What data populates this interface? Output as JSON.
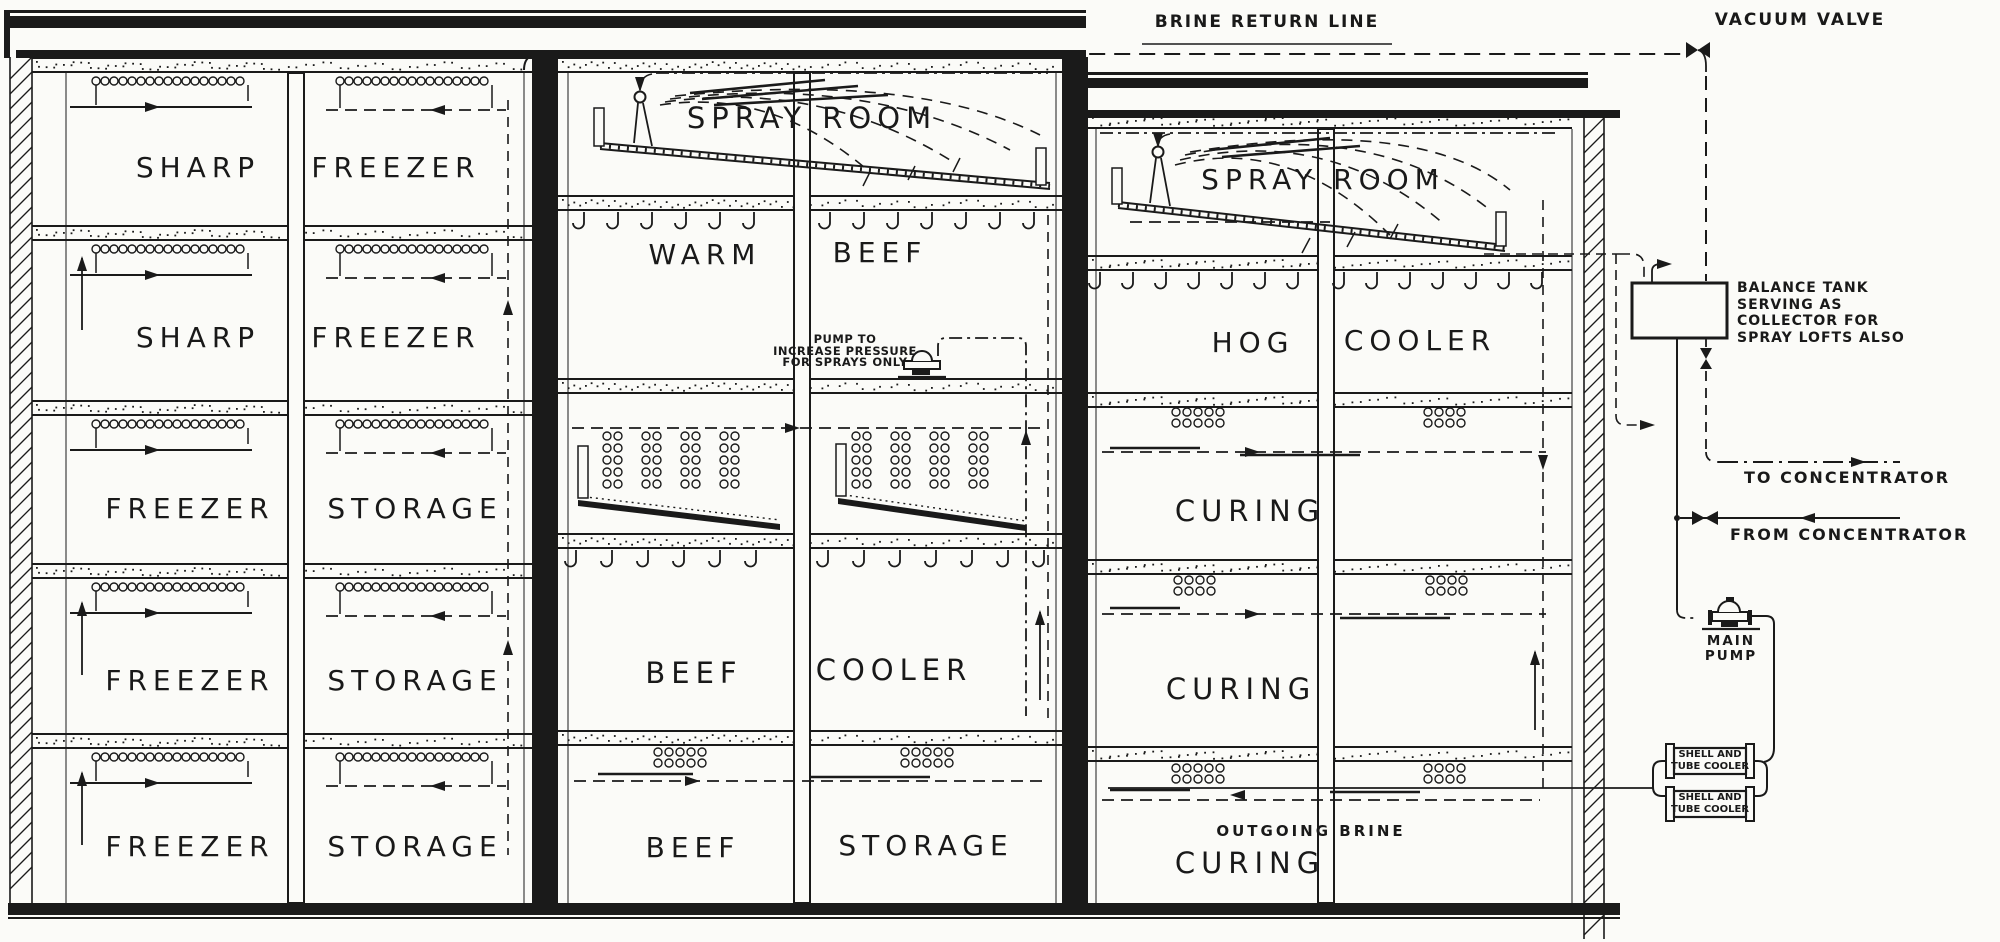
{
  "colors": {
    "ink": "#1a1a1a",
    "paper": "#fbfbf8"
  },
  "top_labels": {
    "brine_return_line": "BRINE RETURN LINE",
    "vacuum_valve": "VACUUM VALVE"
  },
  "left_building": {
    "floors": [
      {
        "rooms": [
          "SHARP",
          "FREEZER"
        ]
      },
      {
        "rooms": [
          "SHARP",
          "FREEZER"
        ]
      },
      {
        "rooms": [
          "FREEZER",
          "STORAGE"
        ]
      },
      {
        "rooms": [
          "FREEZER",
          "STORAGE"
        ]
      },
      {
        "rooms": [
          "FREEZER",
          "STORAGE"
        ]
      }
    ]
  },
  "middle_building": {
    "spray_room": "SPRAY ROOM",
    "floor2_rooms": [
      "WARM",
      "BEEF"
    ],
    "pump_note_lines": [
      "PUMP TO",
      "INCREASE PRESSURE",
      "FOR SPRAYS ONLY"
    ],
    "floor4_rooms": [
      "BEEF",
      "COOLER"
    ],
    "floor5_rooms": [
      "BEEF",
      "STORAGE"
    ]
  },
  "right_building": {
    "spray_room": "SPRAY ROOM",
    "floor2_rooms": [
      "HOG",
      "COOLER"
    ],
    "floor3_room": "CURING",
    "floor4_room": "CURING",
    "floor5_room": "CURING",
    "outgoing_brine_label": "OUTGOING BRINE"
  },
  "external": {
    "balance_tank_note_lines": [
      "BALANCE TANK",
      "SERVING AS",
      "COLLECTOR FOR",
      "SPRAY LOFTS ALSO"
    ],
    "to_concentrator": "TO CONCENTRATOR",
    "from_concentrator": "FROM CONCENTRATOR",
    "main_pump_lines": [
      "MAIN",
      "PUMP"
    ],
    "shell_tube_cooler_top_lines": [
      "SHELL AND",
      "TUBE COOLER"
    ],
    "shell_tube_cooler_bottom_lines": [
      "SHELL AND",
      "TUBE COOLER"
    ]
  }
}
